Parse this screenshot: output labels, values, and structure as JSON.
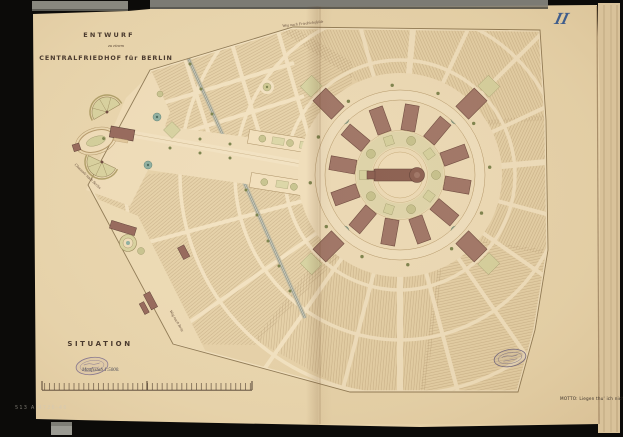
{
  "plate": {
    "number": "II",
    "number_color": "#3f5d8c"
  },
  "title_block": {
    "line1": "ENTWURF",
    "line2": "zu einem",
    "line3": "CENTRALFRIEDHOF für BERLIN"
  },
  "footer": {
    "situation_label": "SITUATION",
    "scale_label": "Maafsstab 1:5000.",
    "motto_label": "MOTTO: Liegen thu' ich nicht.",
    "shelfmark": "513 A 4726-46"
  },
  "road_labels": [
    {
      "id": "top",
      "text": "Weg nach Friedrichsfelde"
    },
    {
      "id": "left",
      "text": "Chaussée nach Berlin"
    },
    {
      "id": "bottom",
      "text": "Weg nach Britz"
    }
  ],
  "stamps": [
    {
      "name": "library-stamp-oval-left"
    },
    {
      "name": "library-stamp-oval-right"
    }
  ],
  "map_features": [
    "burial-field-hatching",
    "radial-avenues",
    "ring-road",
    "central-chapel-building",
    "ring-of-mortuary-buildings",
    "entrance-oval-loop",
    "entrance-gate-building",
    "fan-shaped-gardens",
    "railway-line",
    "garden-parterres",
    "nursery-buildings",
    "scale-bar"
  ],
  "colors": {
    "background": "#0c0b09",
    "paper": "#e9d6af",
    "paper_edge_sheet": "#d9c29a",
    "field_base": "#e6d2aa",
    "hatch_ink": "#a98d66",
    "road_cream": "#f2e2c2",
    "building_brown": "#a1766a",
    "building_outline": "#6e4a40",
    "garden_olive": "#d7d3a2",
    "garden_dark": "#9a9668",
    "teal_parterre": "#8fb0a2",
    "tree_dot": "#7d844f",
    "ink": "#4a3a2e",
    "plate_blue": "#3f5d8c",
    "stamp_violet": "#867895",
    "grey_strip": "#85847c"
  }
}
